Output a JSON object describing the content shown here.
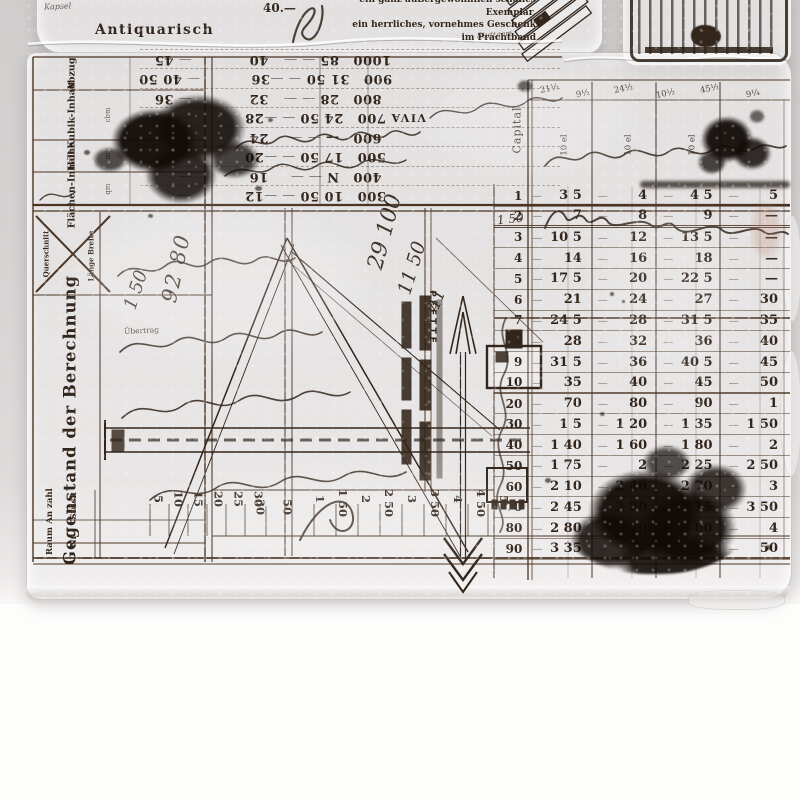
{
  "banner": {
    "word_left": "Kapsel",
    "title": "Antiquarisch",
    "price": "40.—",
    "lines": [
      "ein ganz außergewöhnlich schönes Exemplar,",
      "ein herrliches, vornehmes Geschenk",
      "im Prachtband"
    ],
    "note": "Stuttgart"
  },
  "left_panel": {
    "headers": [
      {
        "label": "Abzug",
        "unit": ""
      },
      {
        "label": "Kubik-Inhalt",
        "unit": "cbm"
      },
      {
        "label": "Höhe",
        "unit": "m"
      },
      {
        "label": "Flächen-Inhalt",
        "unit": "qm"
      }
    ],
    "cross_top": "Querschnitt",
    "cross_bottom": "Länge Breite",
    "main_label": "Gegenstand der Berechnung",
    "anzahl": "An zahl",
    "stueck": "Stück",
    "raum": "Raum",
    "nr": "Nr"
  },
  "flipped_band": {
    "viva": "VIVA",
    "rows": [
      [
        "300",
        "10 50",
        "12",
        ""
      ],
      [
        "400",
        "N",
        "16",
        ""
      ],
      [
        "500",
        "17 50",
        "20",
        ""
      ],
      [
        "600",
        "—",
        "24",
        ""
      ],
      [
        "700",
        "24 50",
        "28",
        ""
      ],
      [
        "800",
        "28",
        "32",
        "36"
      ],
      [
        "900",
        "31 50",
        "36",
        "40 50"
      ],
      [
        "1000",
        "85",
        "40",
        "45"
      ]
    ]
  },
  "right_table": {
    "capital": "Capital",
    "units": [
      "10 el",
      "10 el",
      "10 el"
    ],
    "marks": [
      "21½",
      "9½",
      "24½",
      "10½",
      "45½",
      "9¼"
    ],
    "rows": [
      [
        "1",
        "3 5",
        "4",
        "4 5",
        "5"
      ],
      [
        "2",
        "7",
        "8",
        "9",
        "—"
      ],
      [
        "3",
        "10 5",
        "12",
        "13 5",
        "—"
      ],
      [
        "4",
        "14",
        "16",
        "18",
        "—"
      ],
      [
        "5",
        "17 5",
        "20",
        "22 5",
        "—"
      ],
      [
        "6",
        "21",
        "24",
        "27",
        "30"
      ],
      [
        "7",
        "24 5",
        "28",
        "31 5",
        "35"
      ],
      [
        "8",
        "28",
        "32",
        "36",
        "40"
      ],
      [
        "9",
        "31 5",
        "36",
        "40 5",
        "45"
      ],
      [
        "10",
        "35",
        "40",
        "45",
        "50"
      ],
      [
        "20",
        "70",
        "80",
        "90",
        "1"
      ],
      [
        "30",
        "1 5",
        "1 20",
        "1 35",
        "1 50"
      ],
      [
        "40",
        "1 40",
        "1 60",
        "1 80",
        "2"
      ],
      [
        "50",
        "1 75",
        "2",
        "2 25",
        "2 50"
      ],
      [
        "60",
        "2 10",
        "2 40",
        "2 70",
        "3"
      ],
      [
        "70",
        "2 45",
        "2 80",
        "3 15",
        "3 50"
      ],
      [
        "80",
        "2 80",
        "3 20",
        "3 60",
        "4"
      ],
      [
        "90",
        "3 35",
        "—",
        "—",
        "50"
      ]
    ]
  },
  "drawing": {
    "pfette": "PFETTE"
  },
  "handwriting": {
    "uebertrag": "Übertrag",
    "n1": "92 80",
    "n2": "1 50",
    "n3": "29 100",
    "n4": "11 50",
    "n5": "41",
    "n6": "1 50"
  },
  "bottom_scale": {
    "left": [
      "5",
      "10",
      "15",
      "20",
      "25",
      "30"
    ],
    "partial": [
      "30",
      "50"
    ],
    "center": [
      "1",
      "1 50",
      "2",
      "2 50",
      "3",
      "3 50",
      "4",
      "4 50",
      "5"
    ]
  }
}
